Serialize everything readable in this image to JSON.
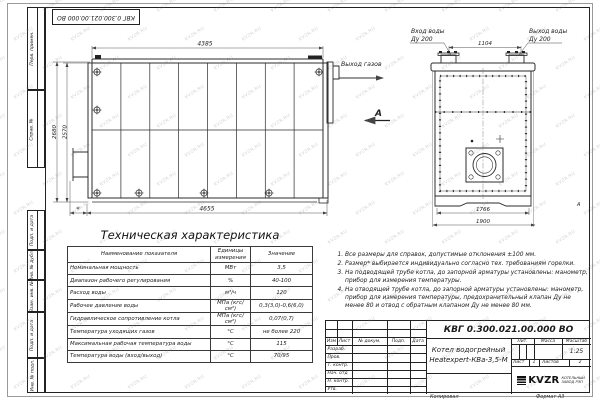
{
  "watermark": {
    "text": "KVZR.RU"
  },
  "frame": {
    "left_labels_top": [
      "Перв. примен.",
      "Справ. №"
    ],
    "left_labels_bottom": [
      "Подп. и дата",
      "Инв. № дубл.",
      "Взам. инв. №",
      "Подп. и дата",
      "Инв. № подл."
    ],
    "zone_label": "А",
    "copy_label": "Копировал",
    "format_label": "Формат А3"
  },
  "drawing": {
    "side_view": {
      "dim_top": "4385",
      "dim_bottom": "4655",
      "dim_left_outer": "2680",
      "dim_left_inner": "2570",
      "asterisk_dim": "*",
      "gas_outlet_label": "Выход газов",
      "view_label": "А"
    },
    "front_view": {
      "inlet_label": "Вход воды",
      "inlet_dn": "Ду 200",
      "outlet_label": "Выход воды",
      "outlet_dn": "Ду 200",
      "dim_nozzle_spacing": "1104",
      "dim_width_inner": "1766",
      "dim_width_outer": "1900"
    }
  },
  "spec_table": {
    "title": "Техническая характеристика",
    "headers": [
      "Наименование показателя",
      "Единицы измерения",
      "Значение"
    ],
    "rows": [
      [
        "Номинальная мощность",
        "МВт",
        "3,5"
      ],
      [
        "Диапазон рабочего регулирования",
        "%",
        "40-100"
      ],
      [
        "Расход воды",
        "м³/ч",
        "120"
      ],
      [
        "Рабочее давление воды",
        "МПа (кгс/см²)",
        "0,3(3,0)-0,6(6,0)"
      ],
      [
        "Гидравлическое сопротивление котла",
        "МПа (кгс/см²)",
        "0,07(0,7)"
      ],
      [
        "Температура уходящих газов",
        "°С",
        "не более 220"
      ],
      [
        "Максимальная рабочая температура воды",
        "°С",
        "115"
      ],
      [
        "Температура воды (вход/выход)",
        "°С",
        "70/95"
      ]
    ]
  },
  "notes": {
    "items": [
      "Все размеры для справок, допустимые отклонения ±100 мм.",
      "Размер* выбирается индивидуально согласно тех. требованиям горелки.",
      "На подводящей трубе котла, до запорной арматуры установлены: манометр, прибор для измерения температуры.",
      "На отводящей трубе котла, до запорной арматуры установлены: манометр, прибор для измерения температуры, предохранительный клапан Ду не менее 80 и отвод с обратным клапаном Ду не менее 80 мм."
    ]
  },
  "title_block": {
    "doc_number": "КВГ 0.300.021.00.000 ВО",
    "product_name_line1": "Котел водогрейный",
    "product_name_line2": "Heatexpert-КВа-3,5-М",
    "lit_label": "Лит.",
    "mass_label": "Масса",
    "scale_label": "Масштаб",
    "scale_value": "1:25",
    "sheet_label": "Лист",
    "sheet_value": "1",
    "sheets_label": "Листов",
    "sheets_value": "2",
    "header_cols": [
      "Изм",
      "Лист",
      "№ докум.",
      "Подп.",
      "Дата"
    ],
    "signature_rows": [
      "Разраб.",
      "Пров.",
      "Т. контр.",
      "Нач. отд",
      "Н. контр.",
      "Утв."
    ],
    "logo_text": "KVZR",
    "logo_caption_line1": "КОТЕЛЬНЫЙ",
    "logo_caption_line2": "ЗАВОД РЭП"
  }
}
